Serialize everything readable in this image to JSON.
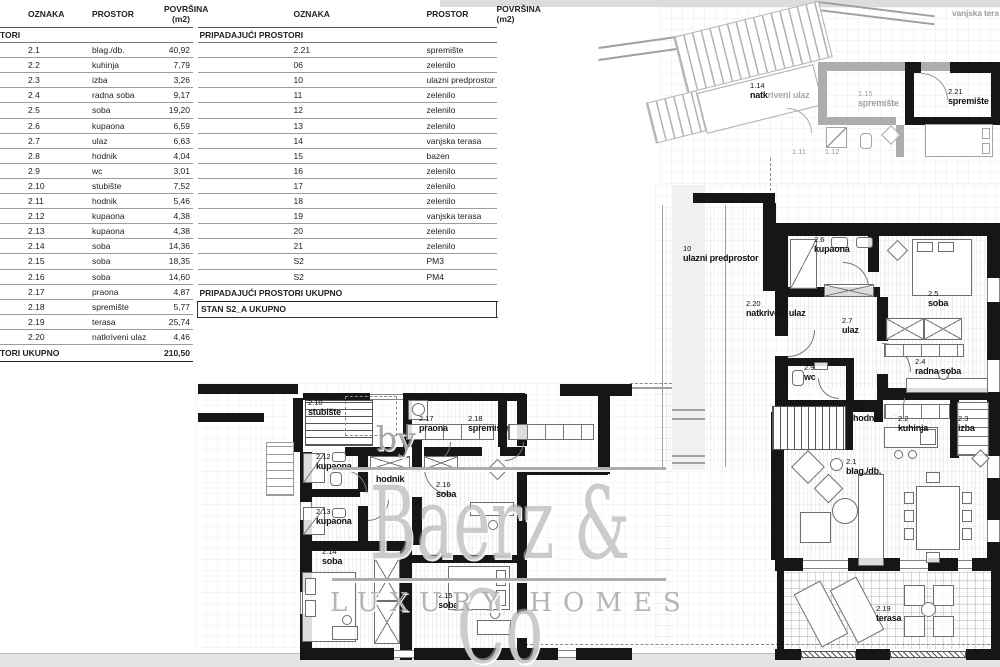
{
  "tables": {
    "columns": {
      "oznaka": "OZNAKA",
      "prostor": "PROSTOR",
      "povrsina": "POVRŠINA (m2)"
    },
    "left": {
      "section": "TORI",
      "rows": [
        {
          "id": "2.1",
          "name": "blag./db.",
          "area": "40,92"
        },
        {
          "id": "2.2",
          "name": "kuhinja",
          "area": "7,79"
        },
        {
          "id": "2.3",
          "name": "izba",
          "area": "3,26"
        },
        {
          "id": "2.4",
          "name": "radna soba",
          "area": "9,17"
        },
        {
          "id": "2.5",
          "name": "soba",
          "area": "19,20"
        },
        {
          "id": "2.6",
          "name": "kupaona",
          "area": "6,59"
        },
        {
          "id": "2.7",
          "name": "ulaz",
          "area": "6,63"
        },
        {
          "id": "2.8",
          "name": "hodnik",
          "area": "4,04"
        },
        {
          "id": "2.9",
          "name": "wc",
          "area": "3,01"
        },
        {
          "id": "2.10",
          "name": "stubište",
          "area": "7,52"
        },
        {
          "id": "2.11",
          "name": "hodnik",
          "area": "5,46"
        },
        {
          "id": "2.12",
          "name": "kupaona",
          "area": "4,38"
        },
        {
          "id": "2.13",
          "name": "kupaona",
          "area": "4,38"
        },
        {
          "id": "2.14",
          "name": "soba",
          "area": "14,36"
        },
        {
          "id": "2.15",
          "name": "soba",
          "area": "18,35"
        },
        {
          "id": "2.16",
          "name": "soba",
          "area": "14,60"
        },
        {
          "id": "2.17",
          "name": "praona",
          "area": "4,87"
        },
        {
          "id": "2.18",
          "name": "spremište",
          "area": "5,77"
        },
        {
          "id": "2.19",
          "name": "terasa",
          "area": "25,74"
        },
        {
          "id": "2.20",
          "name": "natkriveni ulaz",
          "area": "4,46"
        }
      ],
      "total_label": "TORI UKUPNO",
      "total_value": "210,50 m²"
    },
    "right": {
      "section": "PRIPADAJUĆI PROSTORI",
      "rows": [
        {
          "id": "2.21",
          "name": "spremište",
          "area": "6,48"
        },
        {
          "id": "06",
          "name": "zelenilo",
          "area": "3,40"
        },
        {
          "id": "10",
          "name": "ulazni predprostor",
          "area": "16,27"
        },
        {
          "id": "11",
          "name": "zelenilo",
          "area": "17,48"
        },
        {
          "id": "12",
          "name": "zelenilo",
          "area": "3,59"
        },
        {
          "id": "13",
          "name": "zelenilo",
          "area": "37,24"
        },
        {
          "id": "14",
          "name": "vanjska terasa",
          "area": "53,85"
        },
        {
          "id": "15",
          "name": "bazen",
          "area": "27,30"
        },
        {
          "id": "16",
          "name": "zelenilo",
          "area": "83,19"
        },
        {
          "id": "17",
          "name": "zelenilo",
          "area": "30,59"
        },
        {
          "id": "18",
          "name": "zelenilo",
          "area": "8,95"
        },
        {
          "id": "19",
          "name": "vanjska terasa",
          "area": "14,03"
        },
        {
          "id": "20",
          "name": "zelenilo",
          "area": "11,37"
        },
        {
          "id": "21",
          "name": "zelenilo",
          "area": "6,98"
        },
        {
          "id": "S2",
          "name": "PM3",
          "area": "15,01"
        },
        {
          "id": "S2",
          "name": "PM4",
          "area": "15,20"
        }
      ],
      "total_label": "PRIPADAJUĆI PROSTORI UKUPNO",
      "total_value": "350,93 m²",
      "grand_label": "STAN S2_A UKUPNO",
      "grand_value": "561,43 m²"
    }
  },
  "plans": {
    "ghost": {
      "labels": [
        {
          "id": "",
          "name": "vanjska tera"
        },
        {
          "id": "1.14",
          "bold": "natk",
          "rest": "riveni ulaz"
        },
        {
          "id": "1.15",
          "name": "spremište"
        },
        {
          "id": "2.21",
          "name": "spremište"
        },
        {
          "id": "1.11",
          "name": ""
        },
        {
          "id": "1.12",
          "name": ""
        }
      ]
    },
    "right": {
      "rooms": [
        {
          "id": "10",
          "name": "ulazni predprostor"
        },
        {
          "id": "2.20",
          "name": "natkriveni ulaz"
        },
        {
          "id": "2.6",
          "name": "kupaona"
        },
        {
          "id": "2.5",
          "name": "soba"
        },
        {
          "id": "2.7",
          "name": "ulaz"
        },
        {
          "id": "2.9",
          "name": "wc"
        },
        {
          "id": "2.4",
          "name": "radna soba"
        },
        {
          "id": "2.8",
          "name": "hodnik"
        },
        {
          "id": "2.2",
          "name": "kuhinja"
        },
        {
          "id": "2.3",
          "name": "izba"
        },
        {
          "id": "2.1",
          "name": "blag./db."
        },
        {
          "id": "2.19",
          "name": "terasa"
        }
      ]
    },
    "bottom": {
      "rooms": [
        {
          "id": "2.10",
          "name": "stubište"
        },
        {
          "id": "2.17",
          "name": "praona"
        },
        {
          "id": "2.18",
          "name": "spremište"
        },
        {
          "id": "2.12",
          "name": "kupaona"
        },
        {
          "id": "2.11",
          "name": "hodnik"
        },
        {
          "id": "2.16",
          "name": "soba"
        },
        {
          "id": "2.13",
          "name": "kupaona"
        },
        {
          "id": "2.14",
          "name": "soba"
        },
        {
          "id": "2.15",
          "name": "soba"
        }
      ]
    }
  },
  "watermark": {
    "prefix": "by",
    "brand": "Baerz & Co",
    "tagline": "LUXURY HOMES"
  }
}
